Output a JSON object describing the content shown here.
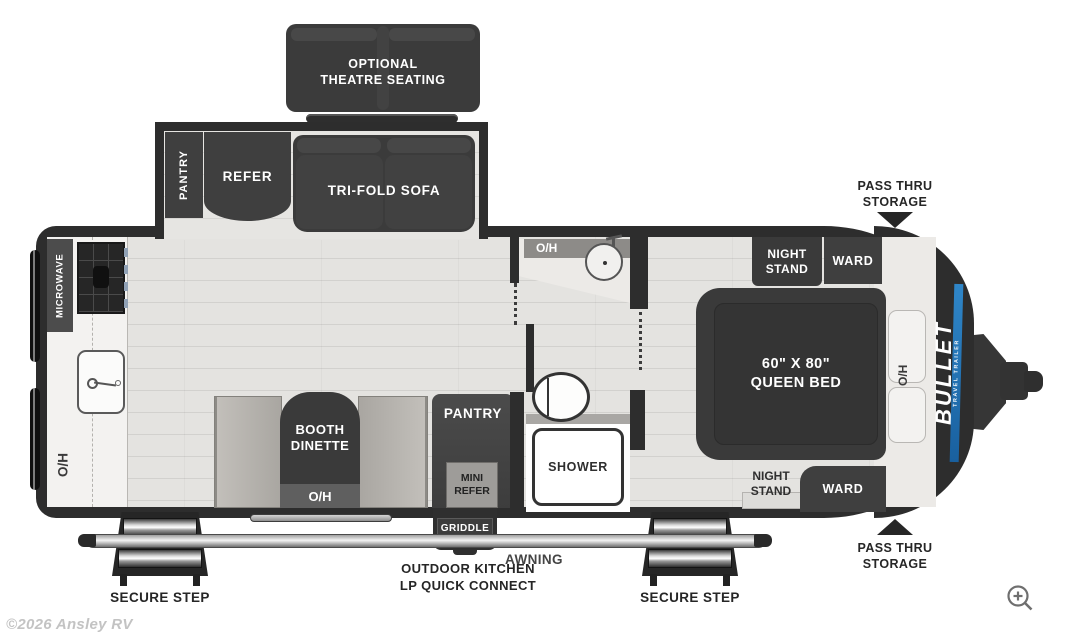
{
  "page": {
    "watermark": "©2026 Ansley RV"
  },
  "colors": {
    "wall": "#2d2d2d",
    "floor": "#e4e3e0",
    "accent_blue": "#1e72b8"
  },
  "exterior": {
    "theatre": "OPTIONAL\nTHEATRE SEATING",
    "pass_thru_top": "PASS THRU\nSTORAGE",
    "pass_thru_bottom": "PASS THRU\nSTORAGE",
    "secure_step_left": "SECURE STEP",
    "secure_step_right": "SECURE STEP",
    "outdoor_kitchen": "OUTDOOR KITCHEN\nLP QUICK CONNECT",
    "awning": "AWNING",
    "griddle": "GRIDDLE"
  },
  "slideout": {
    "pantry": "PANTRY",
    "refer": "REFER",
    "sofa": "TRI-FOLD SOFA"
  },
  "kitchen": {
    "microwave": "MICROWAVE",
    "overhead": "O/H"
  },
  "dinette": {
    "label": "BOOTH\nDINETTE",
    "overhead": "O/H"
  },
  "pantry_main": {
    "label": "PANTRY",
    "mini_refer": "MINI\nREFER"
  },
  "bath": {
    "overhead": "O/H",
    "shower": "SHOWER"
  },
  "bedroom": {
    "night_stand_top": "NIGHT\nSTAND",
    "ward_top": "WARD",
    "bed": "60\" X 80\"\nQUEEN BED",
    "overhead": "O/H",
    "night_stand_bottom": "NIGHT\nSTAND",
    "ward_bottom": "WARD"
  },
  "brand": {
    "name": "BULLET",
    "tagline": "TRAVEL TRAILER"
  }
}
